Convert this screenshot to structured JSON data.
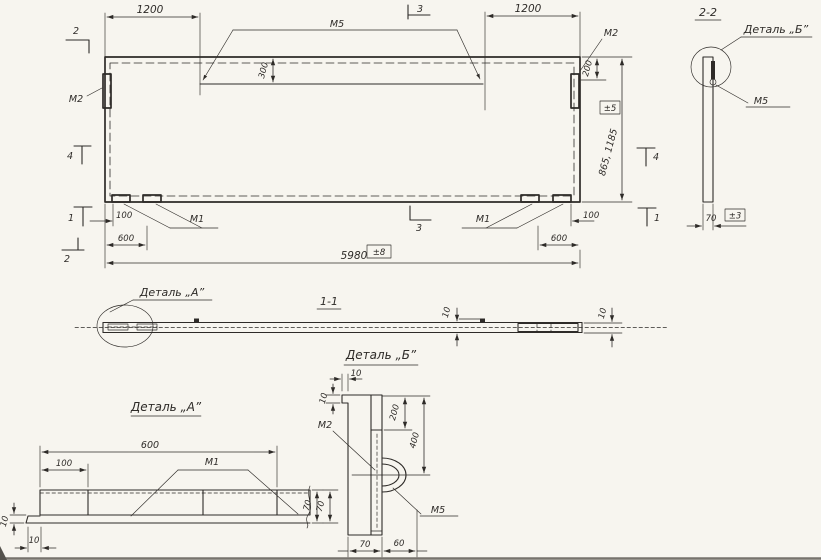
{
  "drawing": {
    "ink_color": "#2e2b28",
    "paper_color": "#f7f5ef",
    "main_view": {
      "dim_span_left": "1200",
      "dim_span_right": "1200",
      "dim_overall": "5980",
      "tol_overall": "±8",
      "dim_height": "865, 1185",
      "tol_height": "±5",
      "dim_loop_offset": "300",
      "dim_edge_plate": "200",
      "dim_plate_offset_left": "100",
      "dim_plate_span_left": "600",
      "dim_plate_offset_right": "100",
      "dim_plate_span_right": "600",
      "label_m5": "М5",
      "label_m2_left": "М2",
      "label_m2_right": "М2",
      "label_m1_left": "М1",
      "label_m1_right": "М1",
      "marker_2_top": "2",
      "marker_4_left": "4",
      "marker_1_left": "1",
      "marker_2_bottom": "2",
      "marker_3_top": "3",
      "marker_3_bottom": "3",
      "marker_4_right": "4",
      "marker_1_right": "1"
    },
    "section22": {
      "title": "2-2",
      "detail_callout": "Деталь „Б”",
      "label_m5": "М5",
      "dim_thickness": "70",
      "tol_thickness": "±3"
    },
    "section11": {
      "title": "1-1",
      "detail_callout": "Деталь „А”",
      "dim_thickness_left": "10",
      "dim_thickness_right": "10"
    },
    "detail_a": {
      "title": "Деталь „А”",
      "dim_span": "600",
      "dim_offset": "100",
      "label_m1": "М1",
      "dim_height": "70",
      "dim_flange_thickness": "10",
      "dim_flange_overhang": "10"
    },
    "detail_b": {
      "title": "Деталь „Б”",
      "dim_lip_width": "10",
      "dim_lip_height": "10",
      "dim_plate_top": "200",
      "dim_loop_axis": "400",
      "label_m2": "М2",
      "label_m5": "М5",
      "dim_loop_height": "70",
      "dim_width": "70",
      "dim_loop_proj": "60"
    }
  }
}
